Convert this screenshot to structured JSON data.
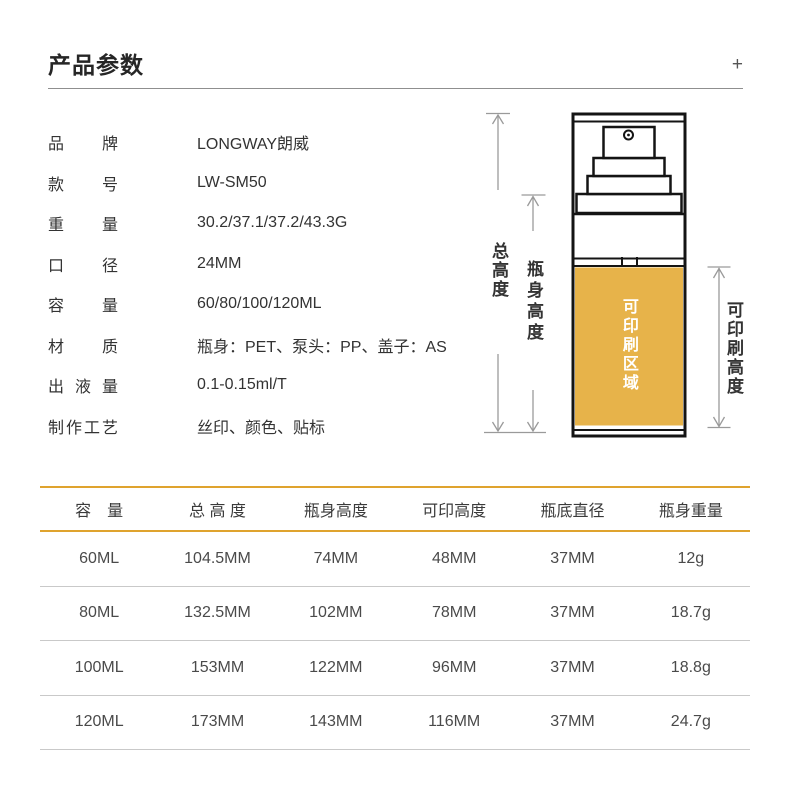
{
  "header": {
    "title": "产品参数",
    "expand_icon": "+"
  },
  "specs": [
    {
      "label": "品牌",
      "value": "LONGWAY朗威"
    },
    {
      "label": "款号",
      "value": "LW-SM50"
    },
    {
      "label": "重量",
      "value": "30.2/37.1/37.2/43.3G"
    },
    {
      "label": "口径",
      "value": "24MM"
    },
    {
      "label": "容量",
      "value": "60/80/100/120ML"
    },
    {
      "label": "材质",
      "value": "瓶身：PET、泵头：PP、盖子：AS"
    },
    {
      "label": "出液量",
      "value": "0.1-0.15ml/T"
    },
    {
      "label": "制作工艺",
      "value": "丝印、颜色、贴标"
    }
  ],
  "diagram": {
    "labels": {
      "total_height": "总高度",
      "body_height": "瓶身高度",
      "printable_area": "可印刷区域",
      "printable_height": "可印刷高度"
    },
    "colors": {
      "printable_fill": "#E7B34A",
      "outline": "#141414",
      "dimension": "#9A9A9A"
    }
  },
  "table": {
    "accent_color": "#DFA32E",
    "columns": [
      "容　量",
      "总 高 度",
      "瓶身高度",
      "可印高度",
      "瓶底直径",
      "瓶身重量"
    ],
    "rows": [
      [
        "60ML",
        "104.5MM",
        "74MM",
        "48MM",
        "37MM",
        "12g"
      ],
      [
        "80ML",
        "132.5MM",
        "102MM",
        "78MM",
        "37MM",
        "18.7g"
      ],
      [
        "100ML",
        "153MM",
        "122MM",
        "96MM",
        "37MM",
        "18.8g"
      ],
      [
        "120ML",
        "173MM",
        "143MM",
        "116MM",
        "37MM",
        "24.7g"
      ]
    ]
  }
}
